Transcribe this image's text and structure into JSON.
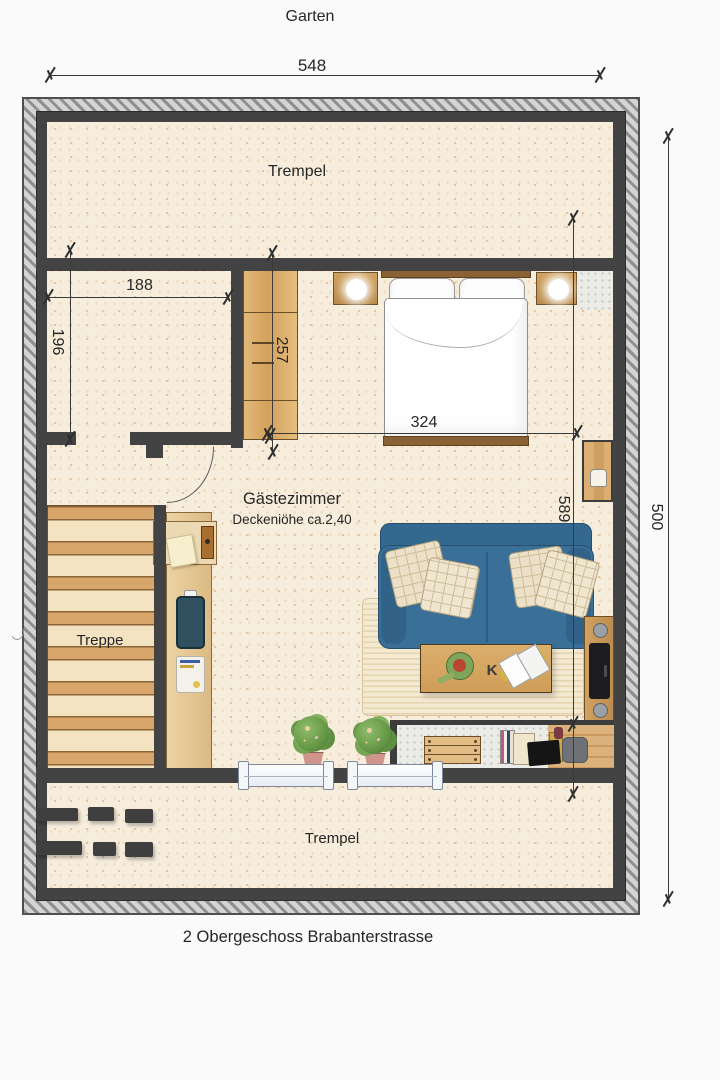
{
  "plan": {
    "site_label": "Garten",
    "caption": "2 Obergeschoss Brabanterstrasse",
    "rooms": {
      "trempel_top": "Trempel",
      "trempel_bottom": "Trempel",
      "treppe": "Treppe",
      "guest_room_name": "Gästezimmer",
      "guest_room_ceiling": "Deckeniöhe ca.2,40"
    },
    "dimensions": {
      "overall_width": "548",
      "overall_height": "500",
      "storage_width": "188",
      "storage_depth": "196",
      "wardrobe_length": "257",
      "bed_wall_span": "324",
      "room_depth": "589"
    },
    "coffee_table_monogram": "K",
    "colors": {
      "wall": "#434343",
      "floor_cream": "#f7eddd",
      "wood": "#d9a96b",
      "sofa_blue": "#3a6f98",
      "text": "#262626"
    }
  }
}
